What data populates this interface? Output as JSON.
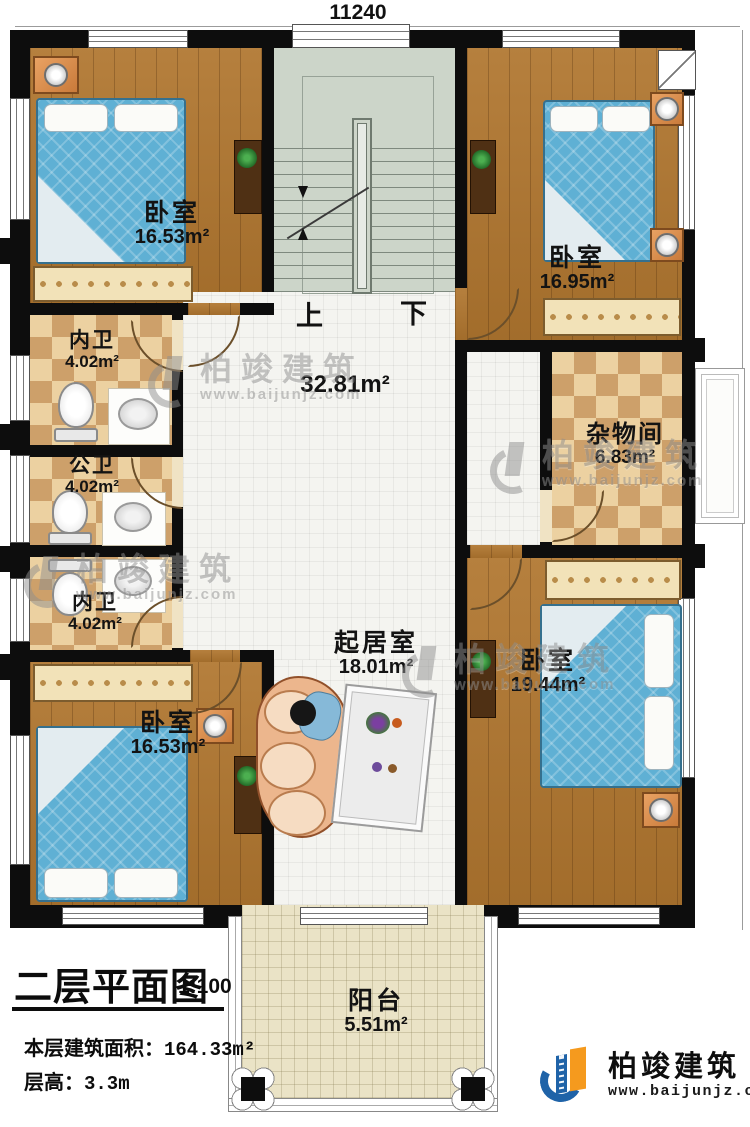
{
  "dimensions": {
    "width_top": "11240",
    "height_right": "17640"
  },
  "stairs": {
    "up_label": "上",
    "down_label": "下"
  },
  "rooms": {
    "bedroom_tl": {
      "name": "卧室",
      "area": "16.53m²"
    },
    "bedroom_tr": {
      "name": "卧室",
      "area": "16.95m²"
    },
    "bedroom_bl": {
      "name": "卧室",
      "area": "16.53m²"
    },
    "bedroom_br": {
      "name": "卧室",
      "area": "19.44m²"
    },
    "bath_inner_top": {
      "name": "内卫",
      "area": "4.02m²"
    },
    "bath_public": {
      "name": "公卫",
      "area": "4.02m²"
    },
    "bath_inner_bottom": {
      "name": "内卫",
      "area": "4.02m²"
    },
    "hallway": {
      "area": "32.81m²"
    },
    "living": {
      "name": "起居室",
      "area": "18.01m²"
    },
    "storage": {
      "name": "杂物间",
      "area": "6.83m²"
    },
    "balcony": {
      "name": "阳台",
      "area": "5.51m²"
    }
  },
  "title_block": {
    "title": "二层平面图",
    "scale": "1:100",
    "floor_area_label": "本层建筑面积：",
    "floor_area_value": "164.33m²",
    "floor_height_label": "层高：",
    "floor_height_value": "3.3m"
  },
  "brand": {
    "name": "柏竣建筑",
    "website": "www.baijunjz.com"
  },
  "watermark": {
    "name": "柏竣建筑",
    "website": "www.baijunjz.com"
  },
  "colors": {
    "wall": "#0d0d0d",
    "wood_floor": "#b0762f",
    "checker_tile": "#cda06a",
    "hall_tile": "#f4f4f0",
    "stair_floor": "#ccd5c9",
    "balcony_floor": "#eae3c6",
    "bed_blue": "#5fb0d4",
    "logo_blue": "#1f63a8",
    "logo_orange": "#f59a1e"
  }
}
